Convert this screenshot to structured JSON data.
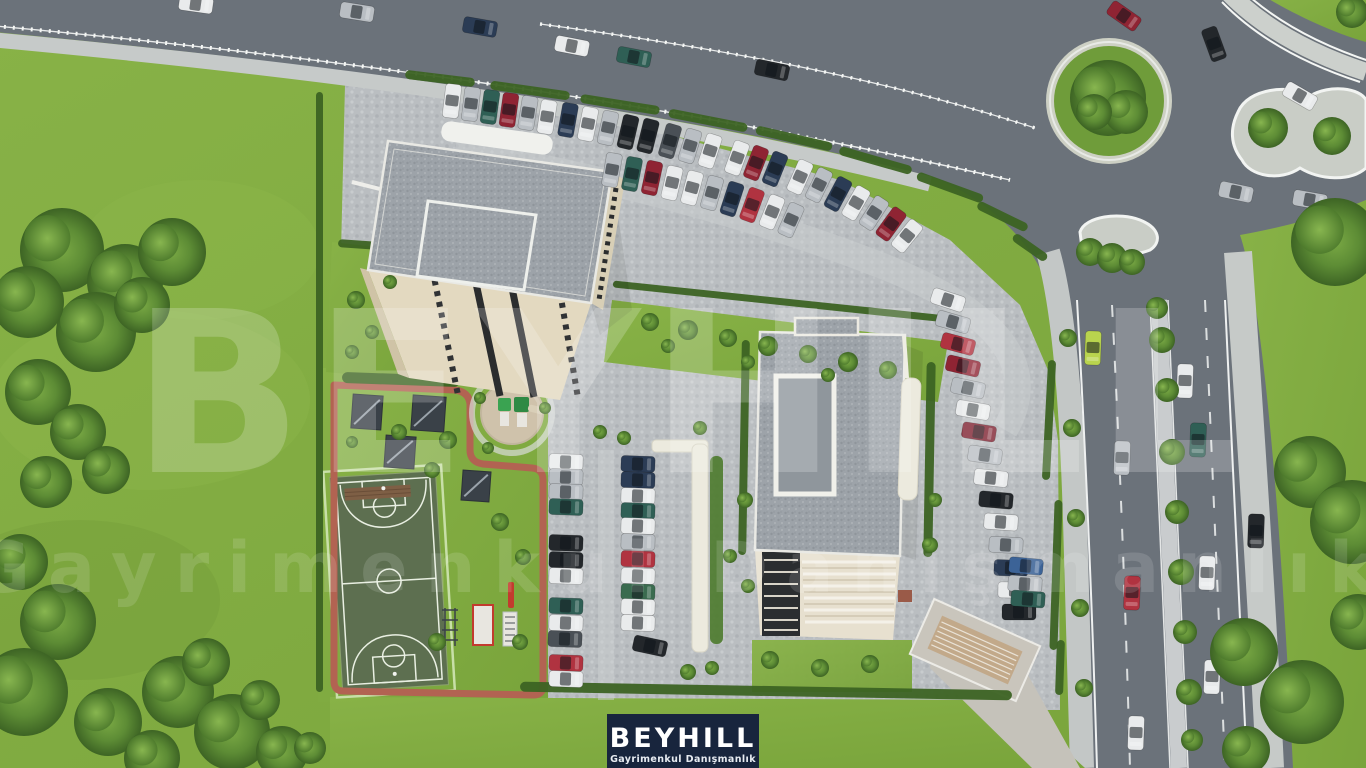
{
  "meta": {
    "title": "Aerial 3D render of BEYHILL residential project site"
  },
  "logo": {
    "name": "BEYHILL",
    "subtitle": "Gayrimenkul Danışmanlık",
    "bg": "#18253d",
    "text_color": "#ffffff"
  },
  "watermark": {
    "line1": "BEYHILL",
    "line2": "Gayrimenkul Danışmanlık",
    "color": "#ffffff"
  },
  "colors": {
    "grass": "#82ab41",
    "grass_light": "#93bc50",
    "grass_dark": "#6d9637",
    "asphalt": "#6b727a",
    "pavement": "#c6cac9",
    "cobble_edge": "#aeb2b5",
    "island": "#c9cdc6",
    "white_line": "#f0f2f1",
    "median": "#c9ccce",
    "roof_trim": "#e9e9e4",
    "facade": "#e3d9c0",
    "facade_shade": "#d8cfb6",
    "window_dark": "#2b2d2e",
    "court": "#5d6f50",
    "court_line": "#e9efe2",
    "court_fence": "#c8dfa8",
    "track": "#b26352",
    "hedge": "#3c6323",
    "pergola": "#3a4148",
    "play_green": "#3aa351",
    "play_red": "#c23b2e",
    "ramp": "#c2a98a",
    "cars": {
      "white": "#e9ebec",
      "silver": "#b9bec3",
      "graywhite": "#d7dadc",
      "black": "#23272b",
      "navy": "#2b3c55",
      "teal": "#2f5f55",
      "green": "#3a6b4f",
      "red": "#b03340",
      "crimson": "#8f2433",
      "maroon": "#7e2230",
      "blue": "#3c6397",
      "lime": "#b9d44e",
      "darkgray": "#4a5056"
    }
  },
  "scene": {
    "cars": [
      {
        "x": 196,
        "y": 4,
        "a": 8,
        "c": "white"
      },
      {
        "x": 357,
        "y": 12,
        "a": 9,
        "c": "silver"
      },
      {
        "x": 480,
        "y": 27,
        "a": 10,
        "c": "navy"
      },
      {
        "x": 572,
        "y": 46,
        "a": 11,
        "c": "white"
      },
      {
        "x": 634,
        "y": 57,
        "a": 11,
        "c": "teal"
      },
      {
        "x": 772,
        "y": 70,
        "a": 12,
        "c": "black"
      },
      {
        "x": 1124,
        "y": 16,
        "a": 35,
        "c": "crimson"
      },
      {
        "x": 1214,
        "y": 44,
        "a": 70,
        "c": "black"
      },
      {
        "x": 1300,
        "y": 96,
        "a": 30,
        "c": "white"
      },
      {
        "x": 1236,
        "y": 192,
        "a": 12,
        "c": "silver"
      },
      {
        "x": 1310,
        "y": 200,
        "a": 10,
        "c": "silver"
      },
      {
        "x": 1093,
        "y": 348,
        "a": 92,
        "c": "lime"
      },
      {
        "x": 1185,
        "y": 381,
        "a": 92,
        "c": "white"
      },
      {
        "x": 1198,
        "y": 440,
        "a": 92,
        "c": "teal"
      },
      {
        "x": 1122,
        "y": 458,
        "a": 92,
        "c": "silver"
      },
      {
        "x": 1207,
        "y": 573,
        "a": 92,
        "c": "white"
      },
      {
        "x": 1132,
        "y": 593,
        "a": 92,
        "c": "red"
      },
      {
        "x": 1212,
        "y": 677,
        "a": 92,
        "c": "white"
      },
      {
        "x": 1136,
        "y": 733,
        "a": 92,
        "c": "white"
      },
      {
        "x": 1256,
        "y": 531,
        "a": 92,
        "c": "black"
      },
      {
        "x": 452,
        "y": 101,
        "a": 97,
        "c": "white"
      },
      {
        "x": 471,
        "y": 104,
        "a": 97,
        "c": "silver"
      },
      {
        "x": 490,
        "y": 107,
        "a": 98,
        "c": "teal"
      },
      {
        "x": 509,
        "y": 110,
        "a": 98,
        "c": "crimson"
      },
      {
        "x": 528,
        "y": 113,
        "a": 99,
        "c": "silver"
      },
      {
        "x": 547,
        "y": 117,
        "a": 99,
        "c": "white"
      },
      {
        "x": 568,
        "y": 120,
        "a": 100,
        "c": "navy"
      },
      {
        "x": 588,
        "y": 124,
        "a": 101,
        "c": "white"
      },
      {
        "x": 608,
        "y": 128,
        "a": 102,
        "c": "silver"
      },
      {
        "x": 628,
        "y": 132,
        "a": 103,
        "c": "black"
      },
      {
        "x": 648,
        "y": 136,
        "a": 104,
        "c": "black"
      },
      {
        "x": 670,
        "y": 141,
        "a": 106,
        "c": "darkgray"
      },
      {
        "x": 690,
        "y": 146,
        "a": 107,
        "c": "silver"
      },
      {
        "x": 710,
        "y": 151,
        "a": 108,
        "c": "white"
      },
      {
        "x": 737,
        "y": 158,
        "a": 110,
        "c": "white"
      },
      {
        "x": 756,
        "y": 163,
        "a": 111,
        "c": "crimson"
      },
      {
        "x": 775,
        "y": 169,
        "a": 112,
        "c": "navy"
      },
      {
        "x": 800,
        "y": 177,
        "a": 114,
        "c": "white"
      },
      {
        "x": 819,
        "y": 185,
        "a": 116,
        "c": "silver"
      },
      {
        "x": 838,
        "y": 194,
        "a": 118,
        "c": "navy"
      },
      {
        "x": 856,
        "y": 203,
        "a": 120,
        "c": "white"
      },
      {
        "x": 874,
        "y": 213,
        "a": 123,
        "c": "silver"
      },
      {
        "x": 891,
        "y": 224,
        "a": 126,
        "c": "crimson"
      },
      {
        "x": 907,
        "y": 236,
        "a": 129,
        "c": "white"
      },
      {
        "x": 612,
        "y": 170,
        "a": 100,
        "c": "silver"
      },
      {
        "x": 632,
        "y": 174,
        "a": 101,
        "c": "teal"
      },
      {
        "x": 652,
        "y": 178,
        "a": 102,
        "c": "crimson"
      },
      {
        "x": 672,
        "y": 183,
        "a": 103,
        "c": "white"
      },
      {
        "x": 692,
        "y": 188,
        "a": 105,
        "c": "white"
      },
      {
        "x": 712,
        "y": 193,
        "a": 106,
        "c": "silver"
      },
      {
        "x": 732,
        "y": 199,
        "a": 108,
        "c": "navy"
      },
      {
        "x": 752,
        "y": 205,
        "a": 110,
        "c": "red"
      },
      {
        "x": 772,
        "y": 212,
        "a": 112,
        "c": "white"
      },
      {
        "x": 791,
        "y": 220,
        "a": 114,
        "c": "silver"
      },
      {
        "x": 948,
        "y": 300,
        "a": 18,
        "c": "white"
      },
      {
        "x": 953,
        "y": 322,
        "a": 16,
        "c": "silver"
      },
      {
        "x": 958,
        "y": 344,
        "a": 15,
        "c": "red"
      },
      {
        "x": 963,
        "y": 366,
        "a": 13,
        "c": "crimson"
      },
      {
        "x": 968,
        "y": 388,
        "a": 12,
        "c": "silver"
      },
      {
        "x": 973,
        "y": 410,
        "a": 10,
        "c": "white"
      },
      {
        "x": 979,
        "y": 432,
        "a": 9,
        "c": "maroon"
      },
      {
        "x": 985,
        "y": 455,
        "a": 8,
        "c": "silver"
      },
      {
        "x": 991,
        "y": 478,
        "a": 6,
        "c": "white"
      },
      {
        "x": 996,
        "y": 500,
        "a": 5,
        "c": "black"
      },
      {
        "x": 1001,
        "y": 522,
        "a": 4,
        "c": "white"
      },
      {
        "x": 1006,
        "y": 545,
        "a": 3,
        "c": "silver"
      },
      {
        "x": 1011,
        "y": 568,
        "a": 2,
        "c": "navy"
      },
      {
        "x": 1015,
        "y": 590,
        "a": 1,
        "c": "white"
      },
      {
        "x": 1019,
        "y": 612,
        "a": 0,
        "c": "black"
      },
      {
        "x": 566,
        "y": 462,
        "a": 2,
        "c": "white"
      },
      {
        "x": 566,
        "y": 477,
        "a": 2,
        "c": "silver"
      },
      {
        "x": 566,
        "y": 492,
        "a": 2,
        "c": "silver"
      },
      {
        "x": 566,
        "y": 507,
        "a": 2,
        "c": "teal"
      },
      {
        "x": 566,
        "y": 543,
        "a": 2,
        "c": "black"
      },
      {
        "x": 566,
        "y": 560,
        "a": 2,
        "c": "black"
      },
      {
        "x": 566,
        "y": 576,
        "a": 2,
        "c": "white"
      },
      {
        "x": 566,
        "y": 606,
        "a": 2,
        "c": "teal"
      },
      {
        "x": 566,
        "y": 623,
        "a": 2,
        "c": "white"
      },
      {
        "x": 565,
        "y": 639,
        "a": 2,
        "c": "darkgray"
      },
      {
        "x": 566,
        "y": 663,
        "a": 2,
        "c": "red"
      },
      {
        "x": 566,
        "y": 679,
        "a": 2,
        "c": "white"
      },
      {
        "x": 638,
        "y": 464,
        "a": 2,
        "c": "navy"
      },
      {
        "x": 638,
        "y": 480,
        "a": 2,
        "c": "navy"
      },
      {
        "x": 638,
        "y": 496,
        "a": 2,
        "c": "white"
      },
      {
        "x": 638,
        "y": 511,
        "a": 2,
        "c": "teal"
      },
      {
        "x": 638,
        "y": 526,
        "a": 2,
        "c": "white"
      },
      {
        "x": 638,
        "y": 542,
        "a": 2,
        "c": "silver"
      },
      {
        "x": 638,
        "y": 559,
        "a": 2,
        "c": "red"
      },
      {
        "x": 638,
        "y": 576,
        "a": 2,
        "c": "white"
      },
      {
        "x": 638,
        "y": 592,
        "a": 2,
        "c": "green"
      },
      {
        "x": 638,
        "y": 607,
        "a": 2,
        "c": "white"
      },
      {
        "x": 638,
        "y": 623,
        "a": 2,
        "c": "white"
      },
      {
        "x": 650,
        "y": 646,
        "a": 12,
        "c": "black"
      },
      {
        "x": 1026,
        "y": 566,
        "a": 5,
        "c": "blue"
      },
      {
        "x": 1025,
        "y": 584,
        "a": 4,
        "c": "silver"
      },
      {
        "x": 1028,
        "y": 599,
        "a": 4,
        "c": "teal"
      }
    ],
    "trees": [
      {
        "x": 62,
        "y": 250,
        "r": 42
      },
      {
        "x": 125,
        "y": 282,
        "r": 38
      },
      {
        "x": 172,
        "y": 252,
        "r": 34
      },
      {
        "x": 96,
        "y": 332,
        "r": 40
      },
      {
        "x": 38,
        "y": 392,
        "r": 33
      },
      {
        "x": 78,
        "y": 432,
        "r": 28
      },
      {
        "x": 142,
        "y": 305,
        "r": 28
      },
      {
        "x": 28,
        "y": 302,
        "r": 36
      },
      {
        "x": 106,
        "y": 470,
        "r": 24
      },
      {
        "x": 46,
        "y": 482,
        "r": 26
      },
      {
        "x": 20,
        "y": 562,
        "r": 28
      },
      {
        "x": 58,
        "y": 622,
        "r": 38
      },
      {
        "x": 24,
        "y": 692,
        "r": 44
      },
      {
        "x": 108,
        "y": 722,
        "r": 34
      },
      {
        "x": 178,
        "y": 692,
        "r": 36
      },
      {
        "x": 232,
        "y": 732,
        "r": 38
      },
      {
        "x": 282,
        "y": 752,
        "r": 26
      },
      {
        "x": 206,
        "y": 662,
        "r": 24
      },
      {
        "x": 152,
        "y": 758,
        "r": 28
      },
      {
        "x": 260,
        "y": 700,
        "r": 20
      },
      {
        "x": 310,
        "y": 748,
        "r": 16
      },
      {
        "x": 1268,
        "y": 128,
        "r": 20
      },
      {
        "x": 1332,
        "y": 136,
        "r": 19
      },
      {
        "x": 1335,
        "y": 242,
        "r": 44
      },
      {
        "x": 1310,
        "y": 472,
        "r": 36
      },
      {
        "x": 1352,
        "y": 522,
        "r": 42
      },
      {
        "x": 1244,
        "y": 652,
        "r": 34
      },
      {
        "x": 1302,
        "y": 702,
        "r": 42
      },
      {
        "x": 1358,
        "y": 622,
        "r": 28
      },
      {
        "x": 1246,
        "y": 750,
        "r": 24
      },
      {
        "x": 1352,
        "y": 12,
        "r": 16
      },
      {
        "x": 1108,
        "y": 98,
        "r": 38
      },
      {
        "x": 1126,
        "y": 112,
        "r": 22
      },
      {
        "x": 1094,
        "y": 112,
        "r": 18
      },
      {
        "x": 1157,
        "y": 308,
        "r": 11
      },
      {
        "x": 1162,
        "y": 340,
        "r": 13
      },
      {
        "x": 1167,
        "y": 390,
        "r": 12
      },
      {
        "x": 1172,
        "y": 452,
        "r": 13
      },
      {
        "x": 1177,
        "y": 512,
        "r": 12
      },
      {
        "x": 1181,
        "y": 572,
        "r": 13
      },
      {
        "x": 1185,
        "y": 632,
        "r": 12
      },
      {
        "x": 1189,
        "y": 692,
        "r": 13
      },
      {
        "x": 1192,
        "y": 740,
        "r": 11
      },
      {
        "x": 1090,
        "y": 252,
        "r": 14
      },
      {
        "x": 1112,
        "y": 258,
        "r": 15
      },
      {
        "x": 1132,
        "y": 262,
        "r": 13
      },
      {
        "x": 650,
        "y": 322,
        "r": 9
      },
      {
        "x": 688,
        "y": 330,
        "r": 10
      },
      {
        "x": 728,
        "y": 338,
        "r": 9
      },
      {
        "x": 768,
        "y": 346,
        "r": 10
      },
      {
        "x": 808,
        "y": 354,
        "r": 9
      },
      {
        "x": 848,
        "y": 362,
        "r": 10
      },
      {
        "x": 888,
        "y": 370,
        "r": 9
      },
      {
        "x": 668,
        "y": 346,
        "r": 7
      },
      {
        "x": 748,
        "y": 362,
        "r": 7
      },
      {
        "x": 828,
        "y": 375,
        "r": 7
      },
      {
        "x": 356,
        "y": 300,
        "r": 9
      },
      {
        "x": 372,
        "y": 332,
        "r": 7
      },
      {
        "x": 390,
        "y": 282,
        "r": 7
      },
      {
        "x": 352,
        "y": 352,
        "r": 7
      },
      {
        "x": 399,
        "y": 432,
        "r": 8
      },
      {
        "x": 448,
        "y": 440,
        "r": 9
      },
      {
        "x": 432,
        "y": 470,
        "r": 8
      },
      {
        "x": 352,
        "y": 442,
        "r": 6
      },
      {
        "x": 500,
        "y": 522,
        "r": 9
      },
      {
        "x": 523,
        "y": 557,
        "r": 8
      },
      {
        "x": 437,
        "y": 642,
        "r": 9
      },
      {
        "x": 520,
        "y": 642,
        "r": 8
      },
      {
        "x": 600,
        "y": 432,
        "r": 7
      },
      {
        "x": 624,
        "y": 438,
        "r": 7
      },
      {
        "x": 700,
        "y": 428,
        "r": 7
      },
      {
        "x": 745,
        "y": 500,
        "r": 8
      },
      {
        "x": 730,
        "y": 556,
        "r": 7
      },
      {
        "x": 688,
        "y": 672,
        "r": 8
      },
      {
        "x": 712,
        "y": 668,
        "r": 7
      },
      {
        "x": 480,
        "y": 398,
        "r": 6
      },
      {
        "x": 545,
        "y": 408,
        "r": 6
      },
      {
        "x": 488,
        "y": 448,
        "r": 6
      },
      {
        "x": 748,
        "y": 586,
        "r": 7
      },
      {
        "x": 930,
        "y": 545,
        "r": 8
      },
      {
        "x": 935,
        "y": 500,
        "r": 7
      },
      {
        "x": 770,
        "y": 660,
        "r": 9
      },
      {
        "x": 820,
        "y": 668,
        "r": 9
      },
      {
        "x": 870,
        "y": 664,
        "r": 9
      },
      {
        "x": 1068,
        "y": 338,
        "r": 9
      },
      {
        "x": 1072,
        "y": 428,
        "r": 9
      },
      {
        "x": 1076,
        "y": 518,
        "r": 9
      },
      {
        "x": 1080,
        "y": 608,
        "r": 9
      },
      {
        "x": 1084,
        "y": 688,
        "r": 9
      }
    ],
    "hedges": [
      {
        "x": 405,
        "y": 74,
        "w": 70,
        "h": 9,
        "a": 7
      },
      {
        "x": 490,
        "y": 86,
        "w": 80,
        "h": 9,
        "a": 8
      },
      {
        "x": 580,
        "y": 100,
        "w": 80,
        "h": 9,
        "a": 9
      },
      {
        "x": 668,
        "y": 116,
        "w": 80,
        "h": 9,
        "a": 11
      },
      {
        "x": 755,
        "y": 134,
        "w": 78,
        "h": 9,
        "a": 13
      },
      {
        "x": 838,
        "y": 156,
        "w": 75,
        "h": 9,
        "a": 16
      },
      {
        "x": 915,
        "y": 183,
        "w": 70,
        "h": 9,
        "a": 20
      },
      {
        "x": 975,
        "y": 212,
        "w": 55,
        "h": 9,
        "a": 26
      },
      {
        "x": 1010,
        "y": 243,
        "w": 40,
        "h": 9,
        "a": 35
      },
      {
        "x": 342,
        "y": 374,
        "w": 118,
        "h": 11,
        "a": 2
      },
      {
        "x": 316,
        "y": 92,
        "w": 7,
        "h": 600,
        "a": 0
      },
      {
        "x": 520,
        "y": 686,
        "w": 492,
        "h": 10,
        "a": 1
      },
      {
        "x": 740,
        "y": 340,
        "w": 8,
        "h": 215,
        "a": 1
      },
      {
        "x": 925,
        "y": 362,
        "w": 9,
        "h": 195,
        "a": 1
      },
      {
        "x": 612,
        "y": 298,
        "w": 336,
        "h": 7,
        "a": 6
      },
      {
        "x": 338,
        "y": 242,
        "w": 84,
        "h": 8,
        "a": 4
      },
      {
        "x": 1045,
        "y": 360,
        "w": 8,
        "h": 120,
        "a": 3
      },
      {
        "x": 1052,
        "y": 500,
        "w": 8,
        "h": 150,
        "a": 2
      },
      {
        "x": 1056,
        "y": 640,
        "w": 8,
        "h": 55,
        "a": 2
      }
    ]
  }
}
